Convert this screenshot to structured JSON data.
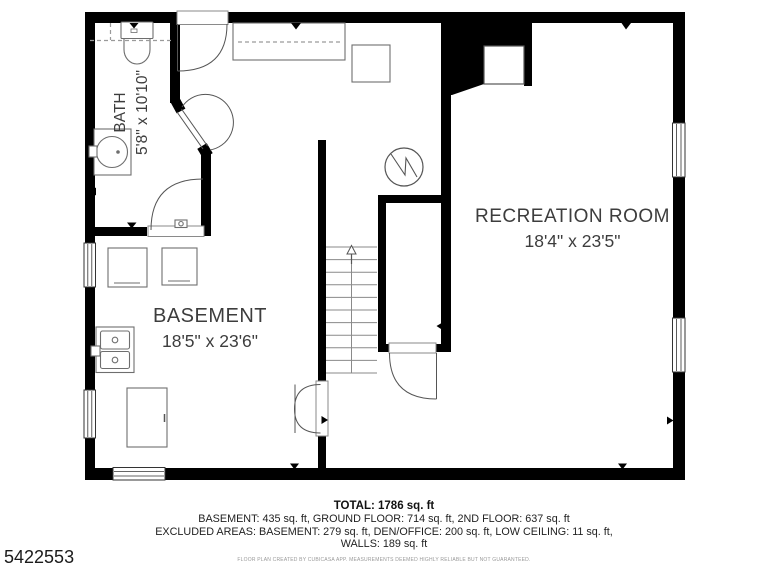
{
  "plan": {
    "id": "5422553",
    "rooms": [
      {
        "name": "BATH",
        "dims": "5'8\" x 10'10\""
      },
      {
        "name": "BASEMENT",
        "dims": "18'5\" x 23'6\""
      },
      {
        "name": "RECREATION ROOM",
        "dims": "18'4\" x 23'5\""
      }
    ],
    "summary": {
      "total": "TOTAL: 1786 sq. ft",
      "floors": "BASEMENT: 435 sq. ft, GROUND FLOOR: 714 sq. ft, 2ND FLOOR: 637 sq. ft",
      "excluded": "EXCLUDED AREAS: BASEMENT: 279 sq. ft, DEN/OFFICE: 200 sq. ft, LOW CEILING: 11 sq. ft,",
      "walls": "WALLS: 189 sq. ft",
      "disclaimer": "FLOOR PLAN CREATED BY CUBICASA APP. MEASUREMENTS DEEMED HIGHLY RELIABLE BUT NOT GUARANTEED."
    },
    "colors": {
      "wall": "#000000",
      "fixture": "#6e6e6e",
      "label": "#3d3d3d"
    }
  }
}
